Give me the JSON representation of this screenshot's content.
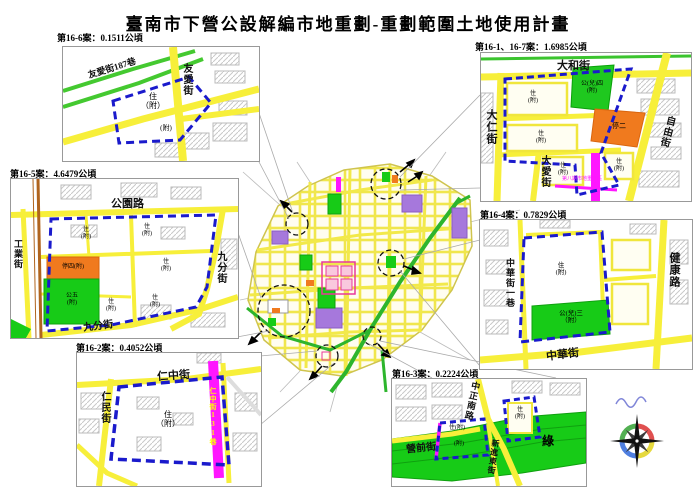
{
  "title": "臺南市下營公設解編市地重劃-重劃範圍土地使用計畫",
  "colors": {
    "boundary_blue": "#1a1acc",
    "road_yellow": "#f7ef3a",
    "park_green": "#17cb17",
    "road_green": "#2db52d",
    "school_purple": "#a678dc",
    "parking_orange": "#f07a1e",
    "lane_magenta": "#ff16ff",
    "commercial_pink": "#e8389a"
  },
  "insets": {
    "i16_6": {
      "label": "第16-6案：0.1511公頃",
      "streets": {
        "youai187": "友愛街187巷",
        "youai": "友愛街"
      },
      "zones": {
        "zhu": "住\n（附）",
        "fu": "(附)"
      }
    },
    "i16_1_7": {
      "label": "第16-1、16-7案：1.6985公頃",
      "streets": {
        "dahe": "大和街",
        "daren": "大仁街",
        "ziyou": "自由街",
        "daai": "大愛街"
      },
      "zones": {
        "zhu1": "住\n(附)",
        "zhu2": "住\n(附)",
        "zhu3": "住\n(附)",
        "zhu4": "住\n(附)",
        "park": "公(兒)四\n(附)",
        "parking": "停二",
        "district8": "第八期市地重劃區"
      }
    },
    "i16_5": {
      "label": "第16-5案：4.6479公頃",
      "streets": {
        "gongyuan": "公園路",
        "jiufen_r": "九分街",
        "jiufen_b": "九分街",
        "gongye": "工業街"
      },
      "zones": {
        "zhu1": "住\n(附)",
        "zhu2": "住\n(附)",
        "zhu3": "住\n(附)",
        "zhu4": "住\n(附)",
        "zhu5": "住\n(附)",
        "parking": "停四(附)",
        "park": "公五\n(附)"
      }
    },
    "i16_4": {
      "label": "第16-4案：0.7829公頃",
      "streets": {
        "zhonghua1": "中華街一巷",
        "jiankang": "健康路",
        "zhonghua": "中華街"
      },
      "zones": {
        "zhu": "住\n(附)",
        "park": "公(兒)三\n（附）"
      }
    },
    "i16_2": {
      "label": "第16-2案：0.4052公頃",
      "streets": {
        "renzhong": "仁中街",
        "renmin": "仁民街",
        "lane": "仁中街131巷"
      },
      "zones": {
        "zhu": "住\n（附）"
      }
    },
    "i16_3": {
      "label": "第16-3案：0.2224公頃",
      "streets": {
        "zhongzheng": "中正南路",
        "yingqian": "營前街",
        "xinjin": "新進東街"
      },
      "zones": {
        "zhu1": "住(附)",
        "fu1": "(附)",
        "zhu2": "住\n(附)",
        "green": "綠"
      }
    }
  }
}
